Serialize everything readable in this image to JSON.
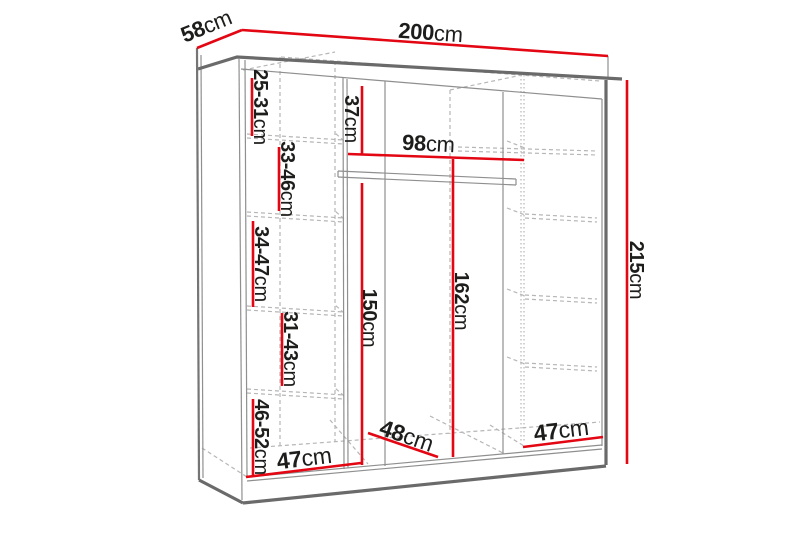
{
  "diagram": {
    "type": "wardrobe-dimension-diagram",
    "description": "Sliding wardrobe technical drawing with red dimension lines",
    "colors": {
      "dimension_red": "#e30613",
      "edge_gray": "#6a6a6a",
      "hidden_edge_gray": "#b6b6b6",
      "text": "#1d1d1b",
      "background": "#ffffff"
    }
  },
  "labels": {
    "width": {
      "num": "200",
      "unit": "cm"
    },
    "depth": {
      "num": "58",
      "unit": "cm"
    },
    "height": {
      "num": "215",
      "unit": "cm"
    },
    "top_clearance": {
      "num": "37",
      "unit": "cm"
    },
    "rail_width": {
      "num": "98",
      "unit": "cm"
    },
    "left_section_height": {
      "num": "150",
      "unit": "cm"
    },
    "middle_section_height": {
      "num": "162",
      "unit": "cm"
    },
    "shelf_gap_1": {
      "num": "25-31",
      "unit": "cm"
    },
    "shelf_gap_2": {
      "num": "33-46",
      "unit": "cm"
    },
    "shelf_gap_3": {
      "num": "34-47",
      "unit": "cm"
    },
    "shelf_gap_4": {
      "num": "31-43",
      "unit": "cm"
    },
    "shelf_gap_5": {
      "num": "46-52",
      "unit": "cm"
    },
    "bottom_left_width": {
      "num": "47",
      "unit": "cm"
    },
    "bottom_middle_depth": {
      "num": "48",
      "unit": "cm"
    },
    "bottom_right_width": {
      "num": "47",
      "unit": "cm"
    }
  }
}
